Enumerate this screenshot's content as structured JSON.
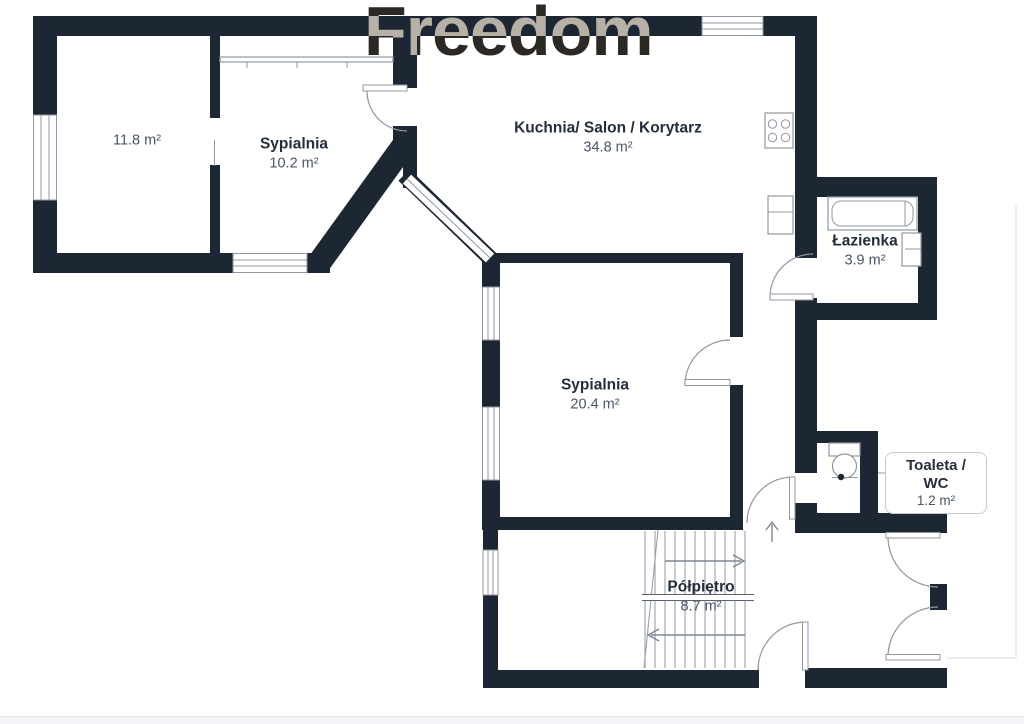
{
  "watermark": {
    "text": "Freedom"
  },
  "colors": {
    "wall": "#1d2633",
    "line": "#9097a2",
    "stair": "#9ba1ac",
    "text-dark": "#252e3b",
    "text-gray": "#4b5563",
    "wm": "#d3d6da",
    "footer-bg": "#f2f4f7",
    "footer-line": "#e3e6ea"
  },
  "rooms": [
    {
      "name": "",
      "area": "11.8 m²"
    },
    {
      "name": "Sypialnia",
      "area": "10.2 m²"
    },
    {
      "name": "Kuchnia/ Salon / Korytarz",
      "area": "34.8 m²"
    },
    {
      "name": "Łazienka",
      "area": "3.9 m²"
    },
    {
      "name": "Sypialnia",
      "area": "20.4 m²"
    },
    {
      "name": "Toaleta / WC",
      "area": "1.2 m²"
    },
    {
      "name": "Półpiętro",
      "area": "8.7 m²"
    }
  ]
}
